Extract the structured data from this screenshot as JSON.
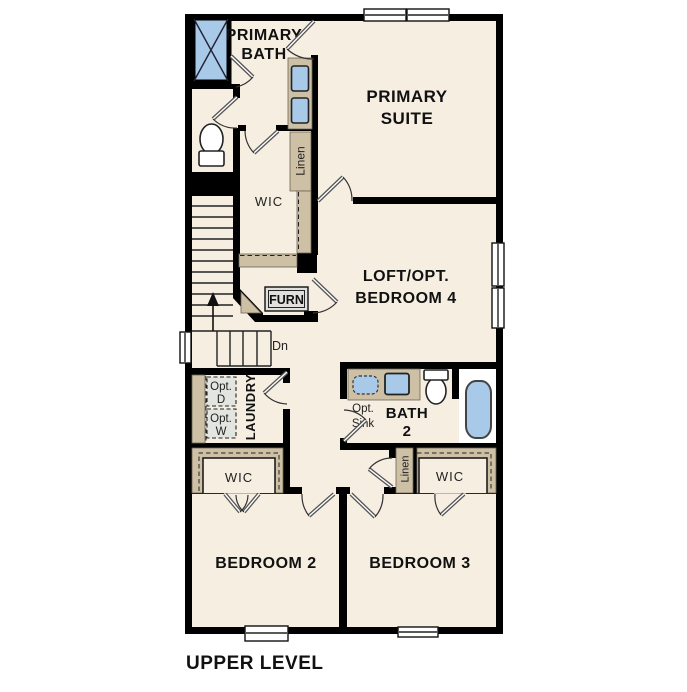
{
  "title": "UPPER LEVEL",
  "colors": {
    "floor": "#f5eee1",
    "wall": "#000000",
    "cabinet": "#cdc0a5",
    "fixture": "#a9c9e9",
    "optbox": "#e3e5e1"
  },
  "labels": {
    "primary_bath": [
      "PRIMARY",
      "BATH"
    ],
    "primary_suite": [
      "PRIMARY",
      "SUITE"
    ],
    "wic_primary": "WIC",
    "linen_upper": "Linen",
    "furnace": "FURN",
    "stairs_down": "Dn",
    "loft": [
      "LOFT/OPT.",
      "BEDROOM 4"
    ],
    "opt_dryer": [
      "Opt.",
      "D"
    ],
    "opt_washer": [
      "Opt.",
      "W"
    ],
    "laundry": "LAUNDRY",
    "opt_sink": [
      "Opt.",
      "Sink"
    ],
    "bath2": [
      "BATH",
      "2"
    ],
    "wic_bedroom2": "WIC",
    "linen_hall": "Linen",
    "wic_bedroom3": "WIC",
    "bedroom2": "BEDROOM 2",
    "bedroom3": "BEDROOM 3"
  }
}
